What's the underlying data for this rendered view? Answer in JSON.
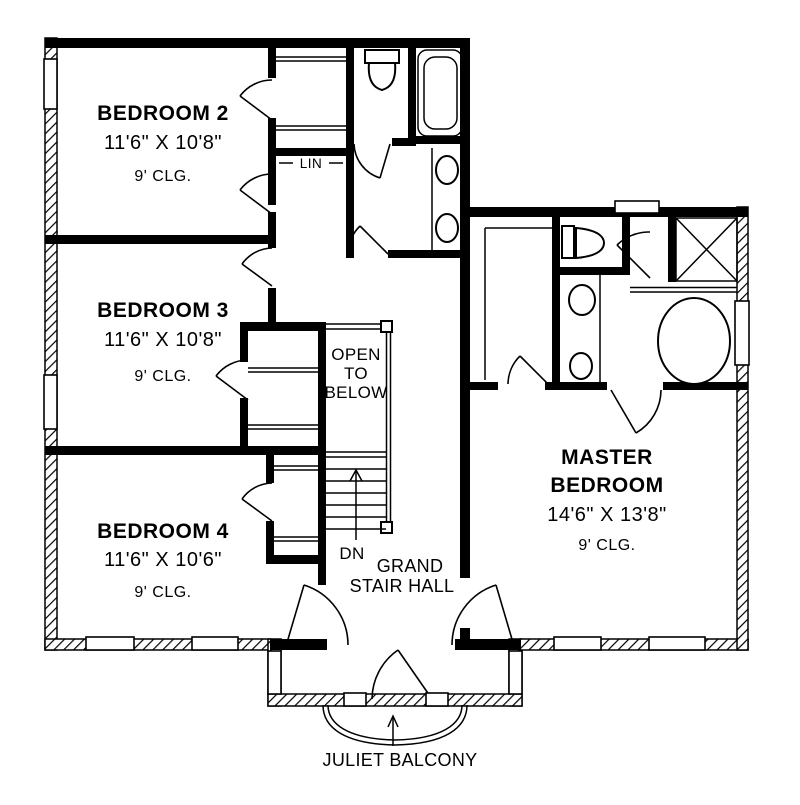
{
  "plan_title": "Second Floor Plan",
  "colors": {
    "wall": "#000000",
    "background": "#ffffff"
  },
  "rooms": {
    "bedroom2": {
      "name": "BEDROOM 2",
      "dims": "11'6\" X 10'8\"",
      "ceiling": "9' CLG."
    },
    "bedroom3": {
      "name": "BEDROOM 3",
      "dims": "11'6\" X 10'8\"",
      "ceiling": "9' CLG."
    },
    "bedroom4": {
      "name": "BEDROOM 4",
      "dims": "11'6\" X 10'6\"",
      "ceiling": "9' CLG."
    },
    "master": {
      "name_line1": "MASTER",
      "name_line2": "BEDROOM",
      "dims": "14'6\" X 13'8\"",
      "ceiling": "9' CLG."
    }
  },
  "labels": {
    "linen": "LIN",
    "open_to_below": {
      "line1": "OPEN",
      "line2": "TO",
      "line3": "BELOW"
    },
    "down": "DN",
    "stair_hall": {
      "line1": "GRAND",
      "line2": "STAIR HALL"
    },
    "juliet_balcony": "JULIET BALCONY"
  }
}
